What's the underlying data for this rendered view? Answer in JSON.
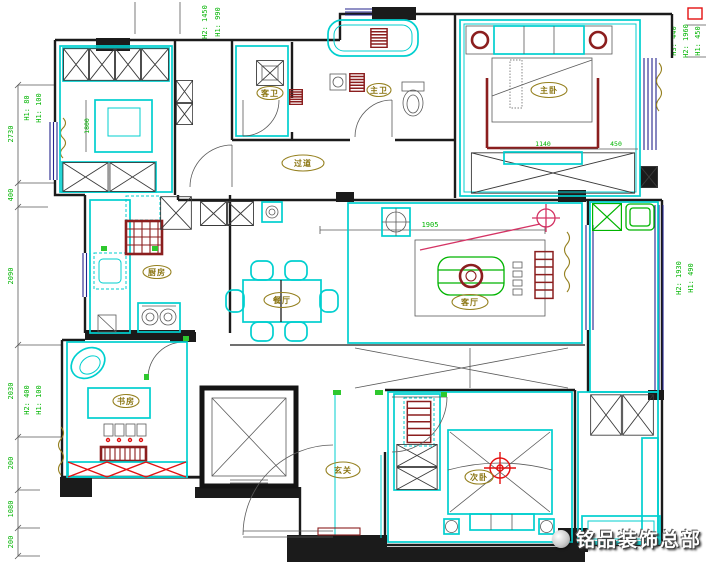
{
  "watermark": {
    "text": "铭品装饰总部"
  },
  "rooms": {
    "master_bedroom": "主卧",
    "master_bath": "主卫",
    "guest_bath": "客卫",
    "corridor": "过道",
    "kitchen": "厨房",
    "dining": "餐厅",
    "living": "客厅",
    "study": "书房",
    "entry": "玄关",
    "bedroom2": "次卧"
  },
  "dims": {
    "left_chain": [
      "2730",
      "400",
      "2090",
      "2030",
      "200",
      "1080",
      "200"
    ],
    "inline": {
      "upper_room_width": "1800",
      "living_width": "1905",
      "bed_width": "1140",
      "bed_side": "450"
    },
    "heights": {
      "top_a": "H2: 1450",
      "top_b": "H1: 990",
      "left_top_a": "H1: 80",
      "left_top_b": "H1: 100",
      "left_mid_a": "H2: 400",
      "left_mid_b": "H1: 100",
      "right_top_a": "H3: 440",
      "right_top_b": "H2: 1960",
      "right_top_c": "H1: 450",
      "right_mid_a": "H2: 1930",
      "right_mid_b": "H1: 490"
    }
  },
  "colors": {
    "wall": "#1b1b1b",
    "furniture_cyan": "#00cfcf",
    "accent_maroon": "#8b1e1e",
    "dimension_green": "#00b400",
    "label_olive": "#8a7410",
    "window_navy": "#23238e",
    "light_red": "#e31111",
    "light_pink": "#d43364"
  }
}
